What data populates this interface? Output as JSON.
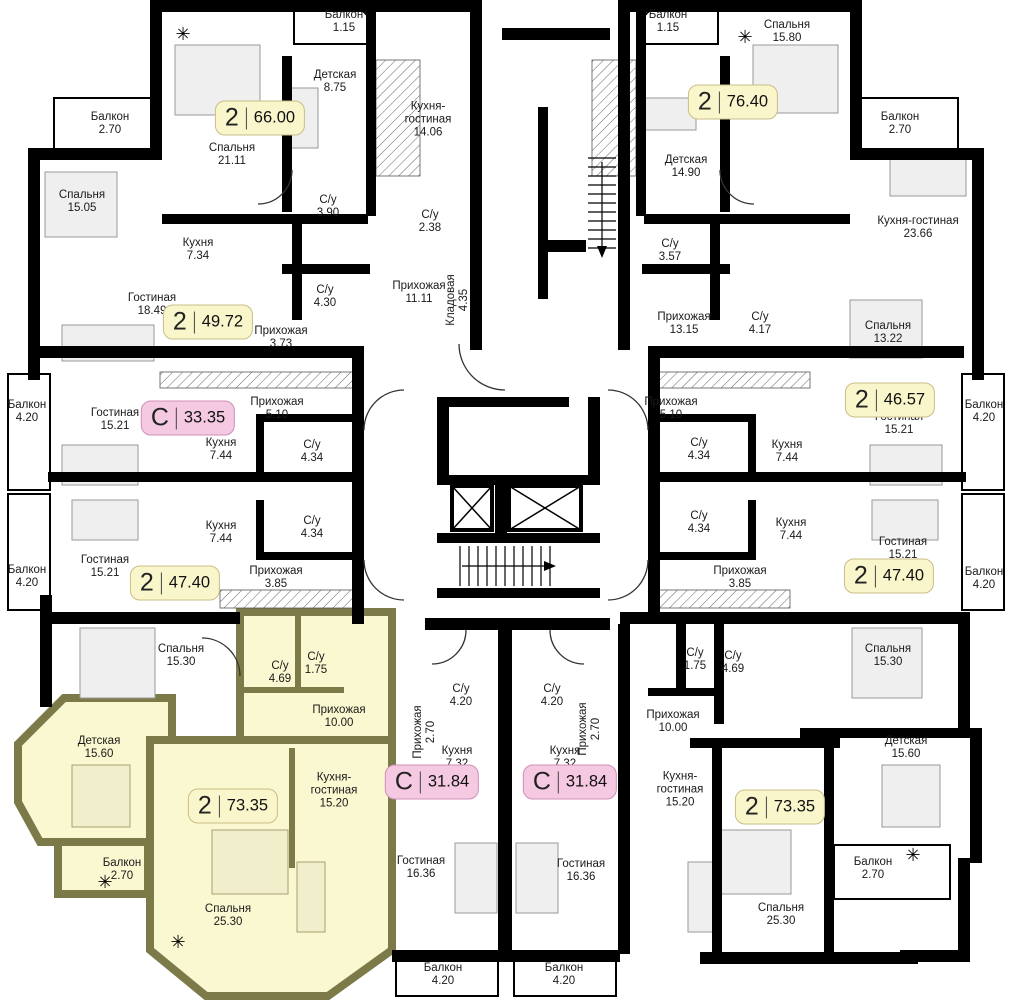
{
  "plan": {
    "title": "Поэтажный план",
    "colors": {
      "wall": "#000000",
      "text": "#1a1a1a",
      "highlight_fill": "#faf8d0",
      "highlight_wall": "#7c7a48",
      "badge_yellow_bg": "#faf6cb",
      "badge_yellow_border": "#c9be85",
      "badge_pink_bg": "#f5c9e1",
      "badge_pink_border": "#ce8fb7"
    },
    "badges": [
      {
        "t": "2",
        "a": "66.00",
        "x": 260,
        "y": 118,
        "s": "yellow"
      },
      {
        "t": "2",
        "a": "76.40",
        "x": 733,
        "y": 102,
        "s": "yellow"
      },
      {
        "t": "2",
        "a": "49.72",
        "x": 208,
        "y": 322,
        "s": "yellow"
      },
      {
        "t": "С",
        "a": "33.35",
        "x": 188,
        "y": 418,
        "s": "pink"
      },
      {
        "t": "2",
        "a": "46.57",
        "x": 890,
        "y": 400,
        "s": "yellow"
      },
      {
        "t": "2",
        "a": "47.40",
        "x": 175,
        "y": 583,
        "s": "yellow"
      },
      {
        "t": "2",
        "a": "47.40",
        "x": 889,
        "y": 576,
        "s": "yellow"
      },
      {
        "t": "С",
        "a": "31.84",
        "x": 432,
        "y": 782,
        "s": "pink"
      },
      {
        "t": "С",
        "a": "31.84",
        "x": 570,
        "y": 782,
        "s": "pink"
      },
      {
        "t": "2",
        "a": "73.35",
        "x": 233,
        "y": 806,
        "s": "yellow",
        "hl": true
      },
      {
        "t": "2",
        "a": "73.35",
        "x": 780,
        "y": 807,
        "s": "yellow"
      }
    ],
    "rooms": [
      {
        "n": "Балкон",
        "a": "1.15",
        "x": 344,
        "y": 22
      },
      {
        "n": "Детская",
        "a": "8.75",
        "x": 335,
        "y": 82
      },
      {
        "n": "Спальня",
        "a": "21.11",
        "x": 232,
        "y": 155
      },
      {
        "n": "Кухня-гостиная",
        "a": "14.06",
        "x": 428,
        "y": 120,
        "w": 1
      },
      {
        "n": "С/у",
        "a": "3.90",
        "x": 328,
        "y": 207
      },
      {
        "n": "Балкон",
        "a": "2.70",
        "x": 110,
        "y": 124
      },
      {
        "n": "Спальня",
        "a": "15.05",
        "x": 82,
        "y": 202
      },
      {
        "n": "Кухня",
        "a": "7.34",
        "x": 198,
        "y": 250
      },
      {
        "n": "Гостиная",
        "a": "18.49",
        "x": 152,
        "y": 305
      },
      {
        "n": "С/у",
        "a": "4.30",
        "x": 325,
        "y": 297
      },
      {
        "n": "Прихожая",
        "a": "3.73",
        "x": 281,
        "y": 338
      },
      {
        "n": "С/у",
        "a": "2.38",
        "x": 430,
        "y": 222
      },
      {
        "n": "Прихожая",
        "a": "11.11",
        "x": 419,
        "y": 293
      },
      {
        "n": "Кладовая",
        "a": "4.35",
        "x": 458,
        "y": 300,
        "r": -90
      },
      {
        "n": "Балкон",
        "a": "1.15",
        "x": 668,
        "y": 22
      },
      {
        "n": "Спальня",
        "a": "15.80",
        "x": 787,
        "y": 32
      },
      {
        "n": "Детская",
        "a": "14.90",
        "x": 686,
        "y": 167
      },
      {
        "n": "Балкон",
        "a": "2.70",
        "x": 900,
        "y": 124
      },
      {
        "n": "Кухня-гостиная",
        "a": "23.66",
        "x": 918,
        "y": 228
      },
      {
        "n": "С/у",
        "a": "3.57",
        "x": 670,
        "y": 251
      },
      {
        "n": "Прихожая",
        "a": "13.15",
        "x": 684,
        "y": 324
      },
      {
        "n": "С/у",
        "a": "4.17",
        "x": 760,
        "y": 324
      },
      {
        "n": "Спальня",
        "a": "13.22",
        "x": 888,
        "y": 333
      },
      {
        "n": "Балкон",
        "a": "4.20",
        "x": 27,
        "y": 412
      },
      {
        "n": "Гостиная",
        "a": "15.21",
        "x": 115,
        "y": 420
      },
      {
        "n": "Прихожая",
        "a": "5.10",
        "x": 277,
        "y": 409
      },
      {
        "n": "Кухня",
        "a": "7.44",
        "x": 221,
        "y": 450
      },
      {
        "n": "С/у",
        "a": "4.34",
        "x": 312,
        "y": 452
      },
      {
        "n": "С/у",
        "a": "4.34",
        "x": 312,
        "y": 528
      },
      {
        "n": "Кухня",
        "a": "7.44",
        "x": 221,
        "y": 533
      },
      {
        "n": "Гостиная",
        "a": "15.21",
        "x": 105,
        "y": 567
      },
      {
        "n": "Прихожая",
        "a": "3.85",
        "x": 276,
        "y": 578
      },
      {
        "n": "Балкон",
        "a": "4.20",
        "x": 27,
        "y": 577
      },
      {
        "n": "Прихожая",
        "a": "5.10",
        "x": 671,
        "y": 409
      },
      {
        "n": "С/у",
        "a": "4.34",
        "x": 699,
        "y": 450
      },
      {
        "n": "Кухня",
        "a": "7.44",
        "x": 787,
        "y": 452
      },
      {
        "n": "Гостиная",
        "a": "15.21",
        "x": 899,
        "y": 424
      },
      {
        "n": "Балкон",
        "a": "4.20",
        "x": 984,
        "y": 412
      },
      {
        "n": "С/у",
        "a": "4.34",
        "x": 699,
        "y": 523
      },
      {
        "n": "Кухня",
        "a": "7.44",
        "x": 791,
        "y": 530
      },
      {
        "n": "Гостиная",
        "a": "15.21",
        "x": 903,
        "y": 549
      },
      {
        "n": "Прихожая",
        "a": "3.85",
        "x": 740,
        "y": 578
      },
      {
        "n": "Балкон",
        "a": "4.20",
        "x": 984,
        "y": 579
      },
      {
        "n": "Спальня",
        "a": "15.30",
        "x": 181,
        "y": 656
      },
      {
        "n": "С/у",
        "a": "4.69",
        "x": 280,
        "y": 673
      },
      {
        "n": "С/у",
        "a": "1.75",
        "x": 316,
        "y": 664
      },
      {
        "n": "Прихожая",
        "a": "10.00",
        "x": 339,
        "y": 717
      },
      {
        "n": "Детская",
        "a": "15.60",
        "x": 99,
        "y": 748
      },
      {
        "n": "Кухня-гостиная",
        "a": "15.20",
        "x": 334,
        "y": 791,
        "w": 1
      },
      {
        "n": "Балкон",
        "a": "2.70",
        "x": 122,
        "y": 870
      },
      {
        "n": "Спальня",
        "a": "25.30",
        "x": 228,
        "y": 916
      },
      {
        "n": "С/у",
        "a": "4.20",
        "x": 461,
        "y": 696
      },
      {
        "n": "С/у",
        "a": "4.20",
        "x": 552,
        "y": 696
      },
      {
        "n": "Прихожая",
        "a": "2.70",
        "x": 425,
        "y": 732,
        "r": -90
      },
      {
        "n": "Прихожая",
        "a": "2.70",
        "x": 590,
        "y": 729,
        "r": -90
      },
      {
        "n": "Кухня",
        "a": "7.32",
        "x": 457,
        "y": 758
      },
      {
        "n": "Кухня",
        "a": "7.32",
        "x": 565,
        "y": 758
      },
      {
        "n": "Гостиная",
        "a": "16.36",
        "x": 421,
        "y": 868
      },
      {
        "n": "Гостиная",
        "a": "16.36",
        "x": 581,
        "y": 871
      },
      {
        "n": "Балкон",
        "a": "4.20",
        "x": 443,
        "y": 975
      },
      {
        "n": "Балкон",
        "a": "4.20",
        "x": 564,
        "y": 975
      },
      {
        "n": "Спальня",
        "a": "15.30",
        "x": 888,
        "y": 656
      },
      {
        "n": "С/у",
        "a": "1.75",
        "x": 695,
        "y": 660
      },
      {
        "n": "С/у",
        "a": "4.69",
        "x": 733,
        "y": 663
      },
      {
        "n": "Прихожая",
        "a": "10.00",
        "x": 673,
        "y": 722
      },
      {
        "n": "Детская",
        "a": "15.60",
        "x": 906,
        "y": 748
      },
      {
        "n": "Кухня-гостиная",
        "a": "15.20",
        "x": 680,
        "y": 790,
        "w": 1
      },
      {
        "n": "Спальня",
        "a": "25.30",
        "x": 781,
        "y": 915
      },
      {
        "n": "Балкон",
        "a": "2.70",
        "x": 873,
        "y": 869
      }
    ]
  }
}
